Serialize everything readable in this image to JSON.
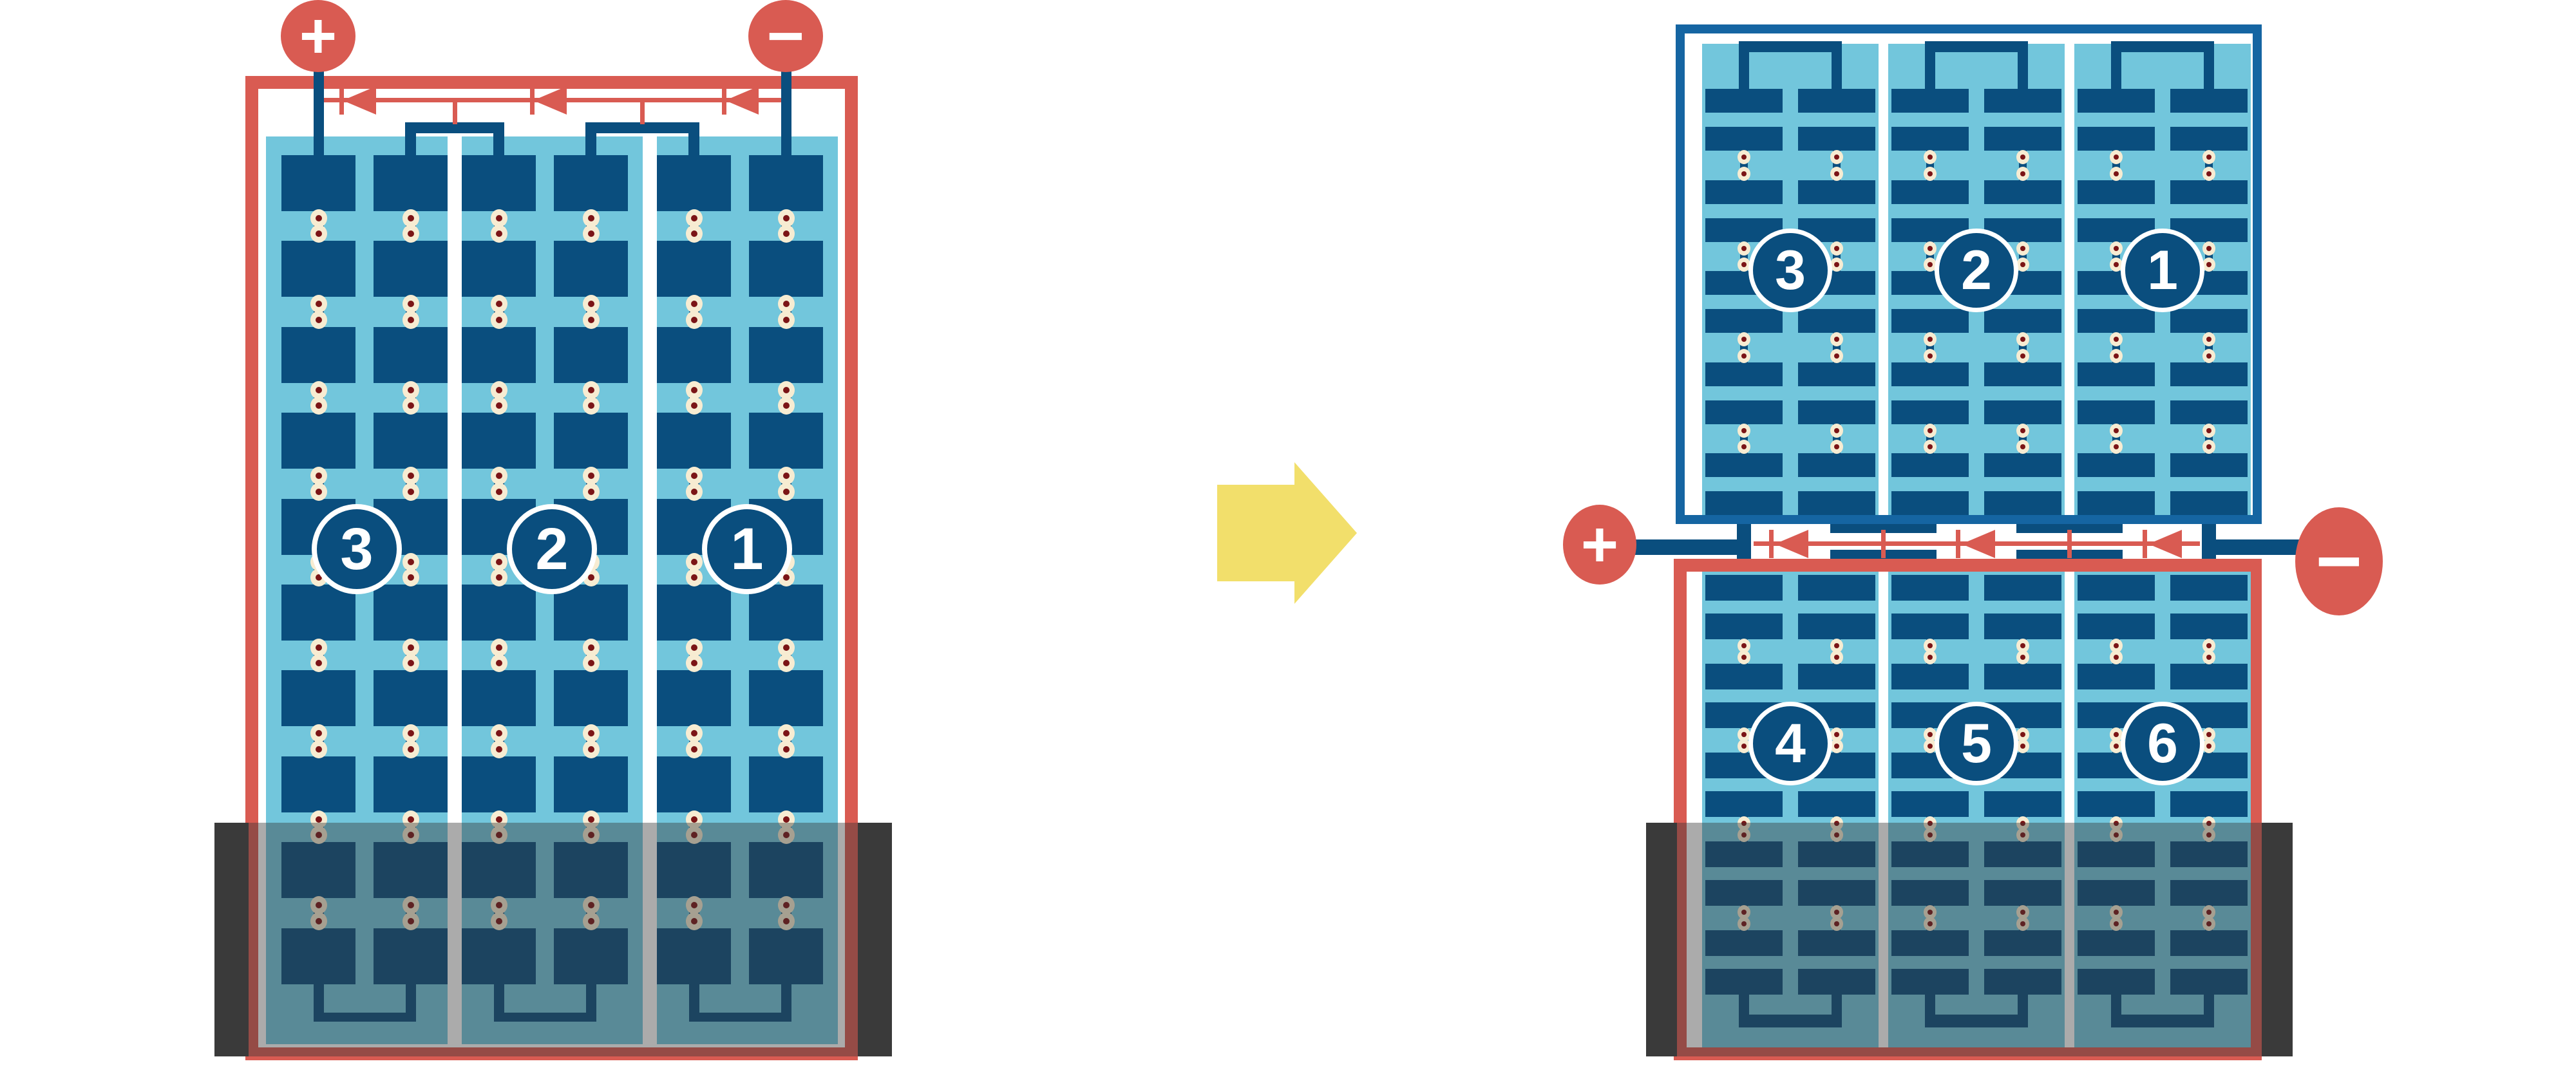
{
  "colors": {
    "red": "#D95B52",
    "navy": "#0A4E7E",
    "light_blue": "#72C6DC",
    "case_blue": "#1565A2",
    "cream": "#F7ECD2",
    "maroon": "#7B1416",
    "yellow": "#F2DF6B",
    "tray_gray": "#3A3A3A",
    "tray_overlay": "rgba(55,55,55,0.42)",
    "background": "#FFFFFF"
  },
  "left_battery": {
    "positive_label": "+",
    "negative_label": "−",
    "cell_numbers": [
      "3",
      "2",
      "1"
    ],
    "module_count": 3,
    "columns_per_module": 2,
    "rows_per_column": 10
  },
  "right_battery": {
    "positive_label": "+",
    "negative_label": "−",
    "top_cell_numbers": [
      "3",
      "2",
      "1"
    ],
    "bottom_cell_numbers": [
      "4",
      "5",
      "6"
    ],
    "module_count_per_box": 3,
    "columns_per_module": 2,
    "rows_per_column": 10
  },
  "transform_arrow": {
    "direction": "right"
  }
}
